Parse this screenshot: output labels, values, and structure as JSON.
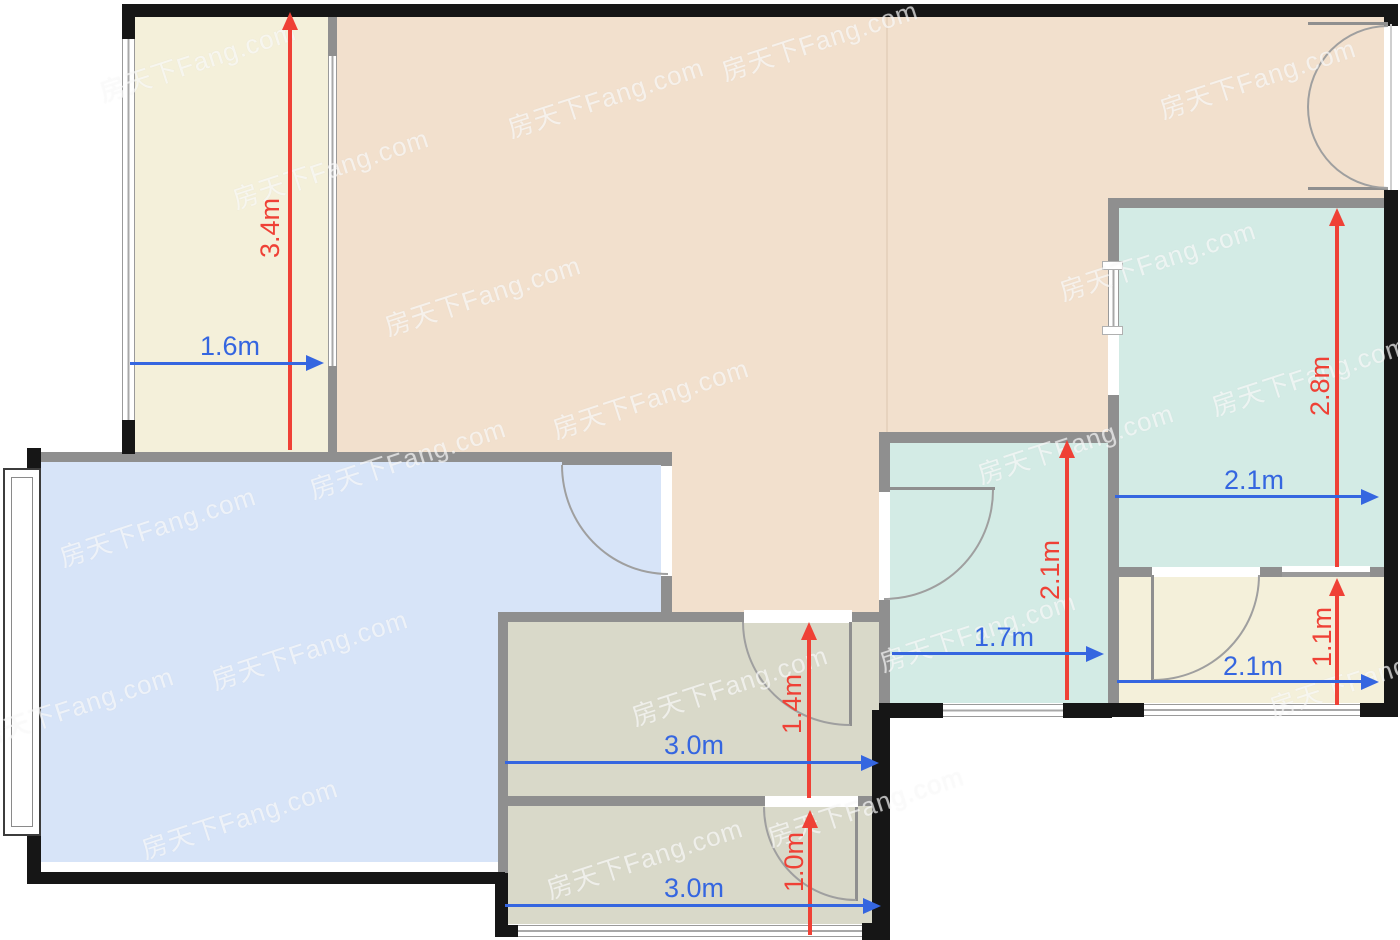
{
  "watermark": {
    "text": "房天下Fang.com",
    "positions": [
      [
        185,
        58
      ],
      [
        807,
        37
      ],
      [
        1245,
        75
      ],
      [
        593,
        94
      ],
      [
        318,
        165
      ],
      [
        470,
        292
      ],
      [
        1145,
        257
      ],
      [
        1297,
        372
      ],
      [
        638,
        395
      ],
      [
        395,
        455
      ],
      [
        145,
        523
      ],
      [
        1063,
        440
      ],
      [
        965,
        628
      ],
      [
        297,
        646
      ],
      [
        717,
        682
      ],
      [
        63,
        703
      ],
      [
        1355,
        673
      ],
      [
        227,
        815
      ],
      [
        632,
        855
      ],
      [
        853,
        803
      ]
    ]
  },
  "palette": {
    "wall_exterior": "#161616",
    "wall_interior": "#8f8f8f",
    "room_cream": "#f4f0da",
    "room_peach": "#f2e0cd",
    "room_blue": "#d7e4f8",
    "room_teal": "#d3ebe5",
    "room_olive": "#d9d9c9",
    "arrow_red": "#ef4136",
    "arrow_blue": "#3566e0",
    "door_arc": "#9f9f9f",
    "window_line": "#a8a8a8"
  },
  "dimensions": {
    "balcony_height": {
      "label": "3.4m",
      "orientation": "vertical",
      "color": "red"
    },
    "balcony_width": {
      "label": "1.6m",
      "orientation": "horizontal",
      "color": "blue"
    },
    "bedroom_right_height": {
      "label": "2.8m",
      "orientation": "vertical",
      "color": "red"
    },
    "bedroom_right_width": {
      "label": "2.1m",
      "orientation": "horizontal",
      "color": "blue"
    },
    "bath_height": {
      "label": "2.1m",
      "orientation": "vertical",
      "color": "red"
    },
    "bath_width": {
      "label": "1.7m",
      "orientation": "horizontal",
      "color": "blue"
    },
    "small_room_height": {
      "label": "1.1m",
      "orientation": "vertical",
      "color": "red"
    },
    "small_room_width": {
      "label": "2.1m",
      "orientation": "horizontal",
      "color": "blue"
    },
    "room_mid_height": {
      "label": "1.4m",
      "orientation": "vertical",
      "color": "red"
    },
    "room_mid_width": {
      "label": "3.0m",
      "orientation": "horizontal",
      "color": "blue"
    },
    "room_bottom_height": {
      "label": "1.0m",
      "orientation": "vertical",
      "color": "red"
    },
    "room_bottom_width": {
      "label": "3.0m",
      "orientation": "horizontal",
      "color": "blue"
    }
  }
}
